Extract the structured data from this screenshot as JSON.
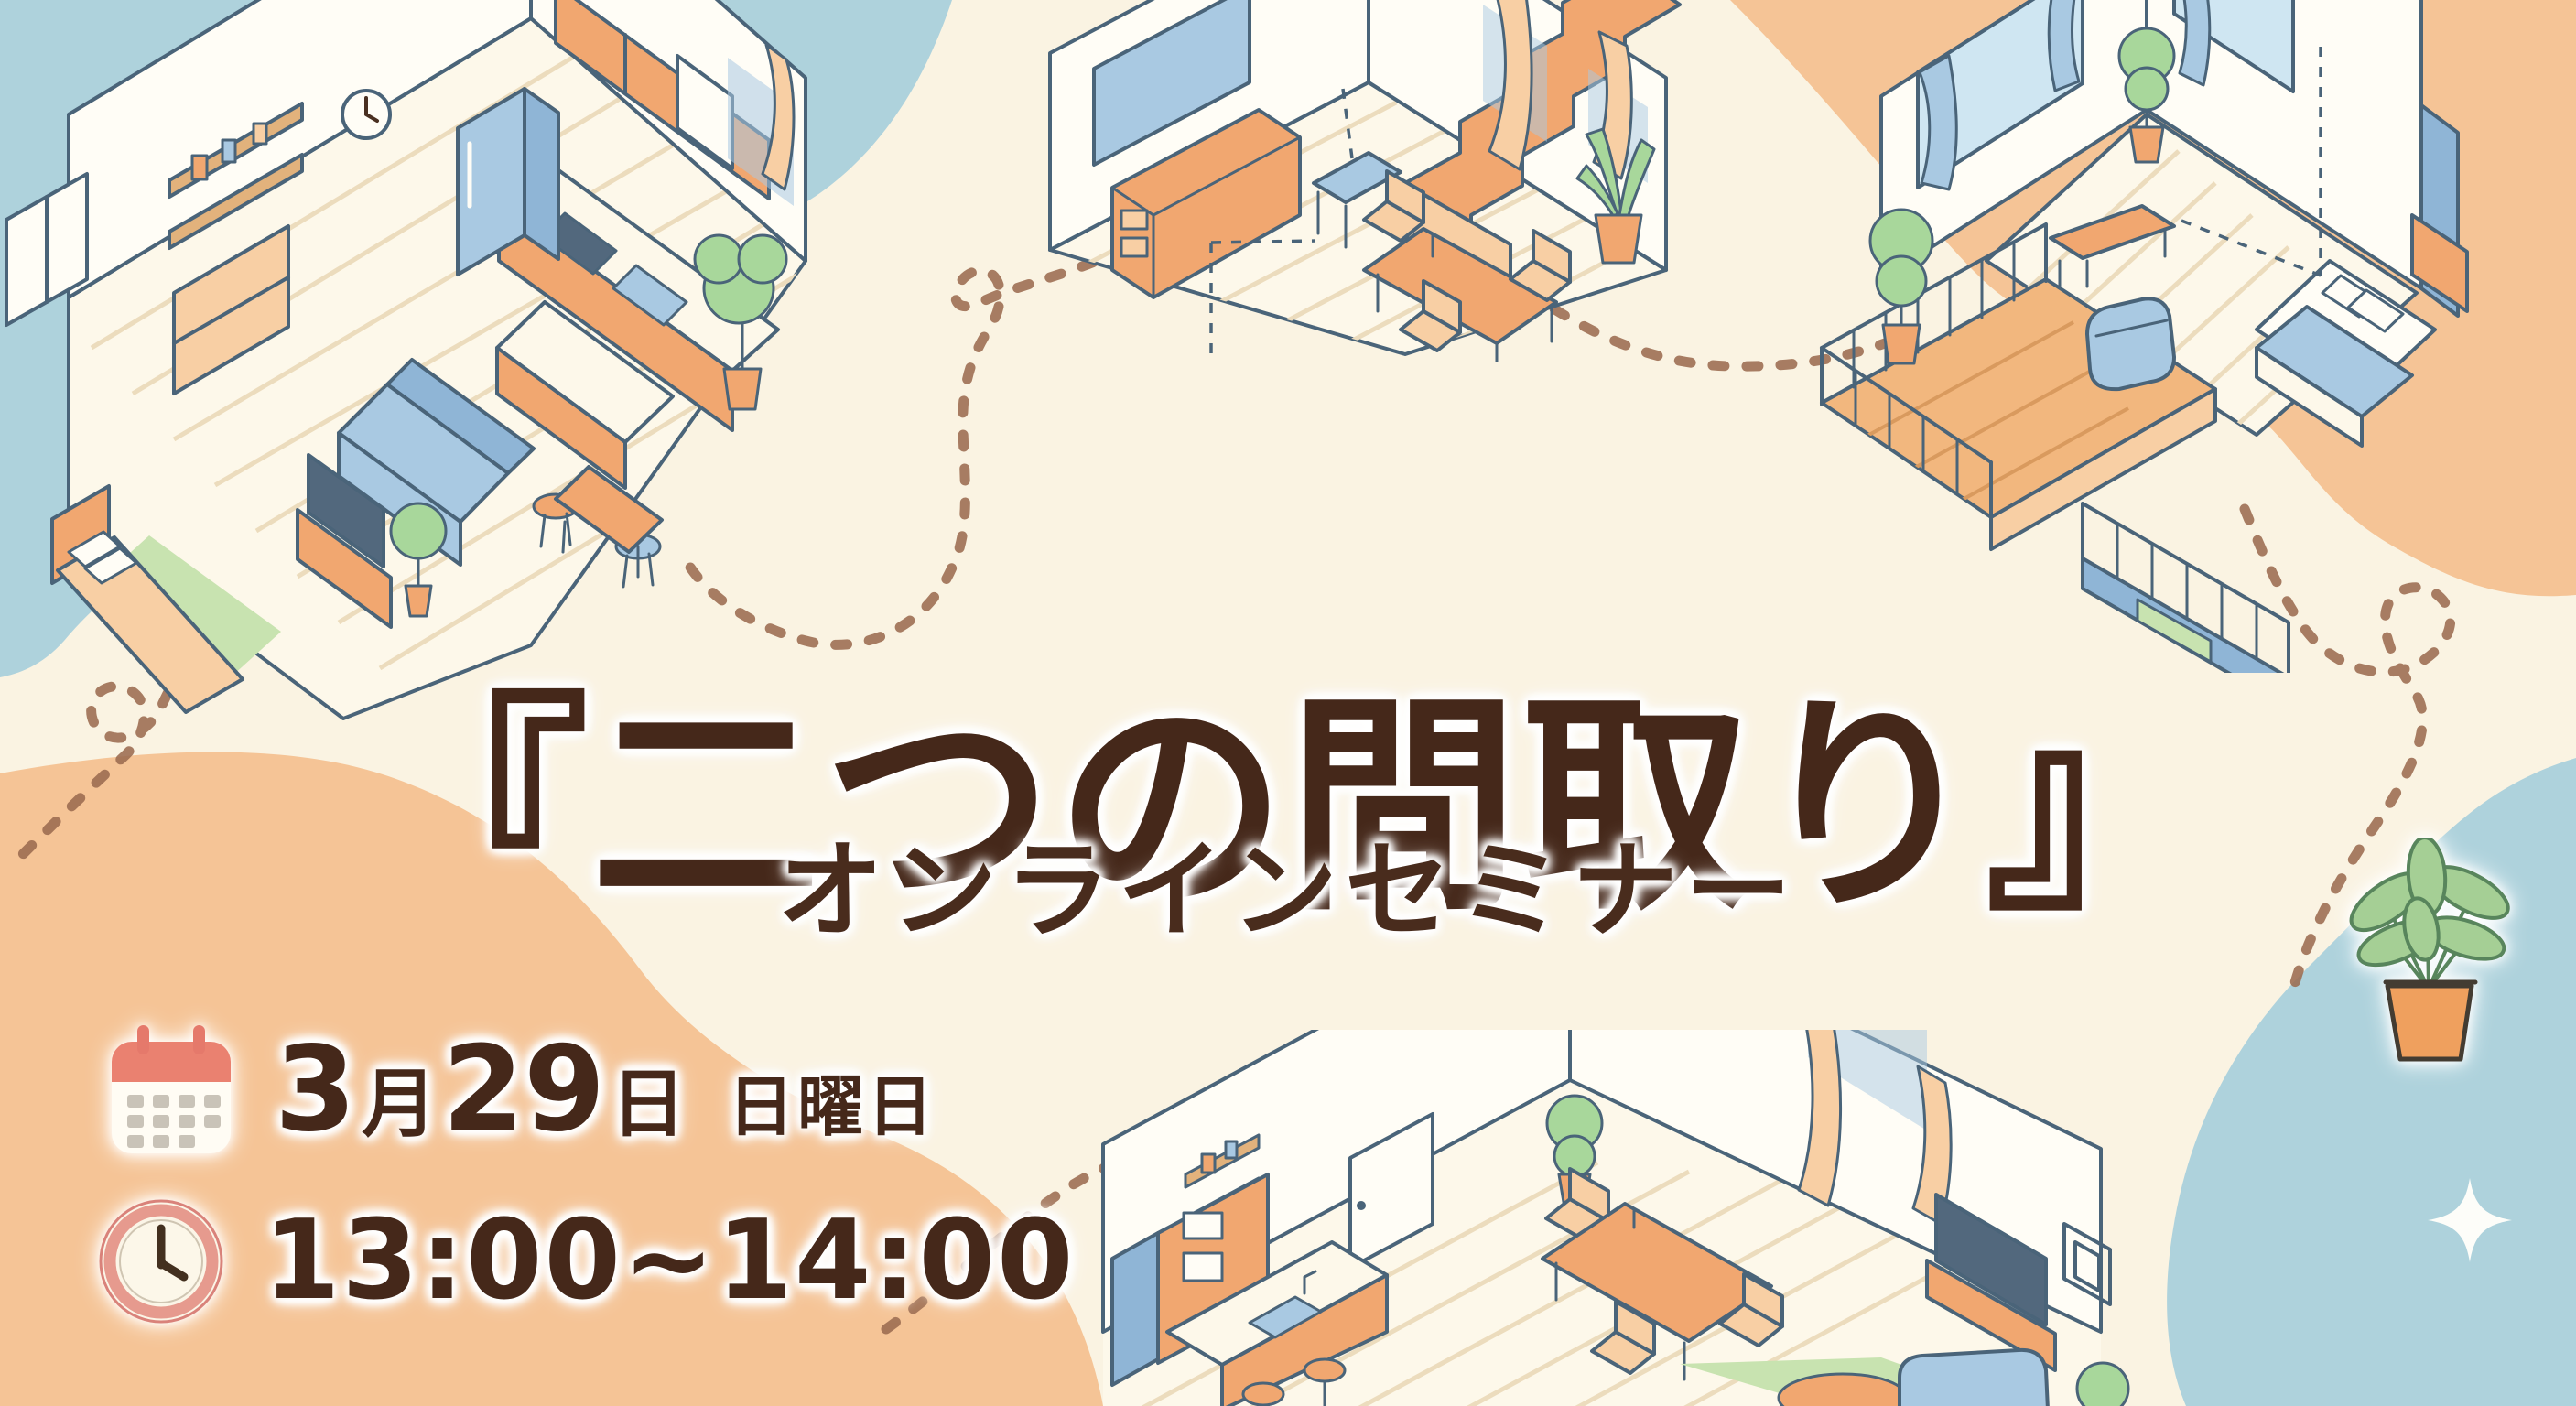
{
  "event": {
    "title": "『二つの間取り』",
    "subtitle": "オンラインセミナー",
    "date": {
      "month_number": "3",
      "month_suffix": "月",
      "day_number": "29",
      "day_suffix": "日",
      "weekday": "日曜日"
    },
    "time_range": "13:00~14:00"
  },
  "icons": {
    "calendar": "calendar-icon",
    "clock": "clock-icon",
    "sparkle": "sparkle-icon",
    "potted_plant": "potted-plant-icon"
  },
  "illustrations": {
    "top_left": "isometric floor plan: studio with kitchen, sofa, TV and bed",
    "top_center": "isometric floor plan: room with staircase, desk and dining set",
    "top_right": "isometric floor plan: bedroom with balcony deck",
    "bottom_center": "isometric floor plan: LDK with kitchen counter, dining table, TV and sofa"
  },
  "colors": {
    "background": "#faf3e2",
    "blob_blue": "#aed2dc",
    "blob_orange": "#f5c496",
    "text_brown": "#45281a",
    "calendar_red": "#ea8170",
    "clock_pink": "#e69a8e",
    "dotted_line": "#9b6b50"
  }
}
